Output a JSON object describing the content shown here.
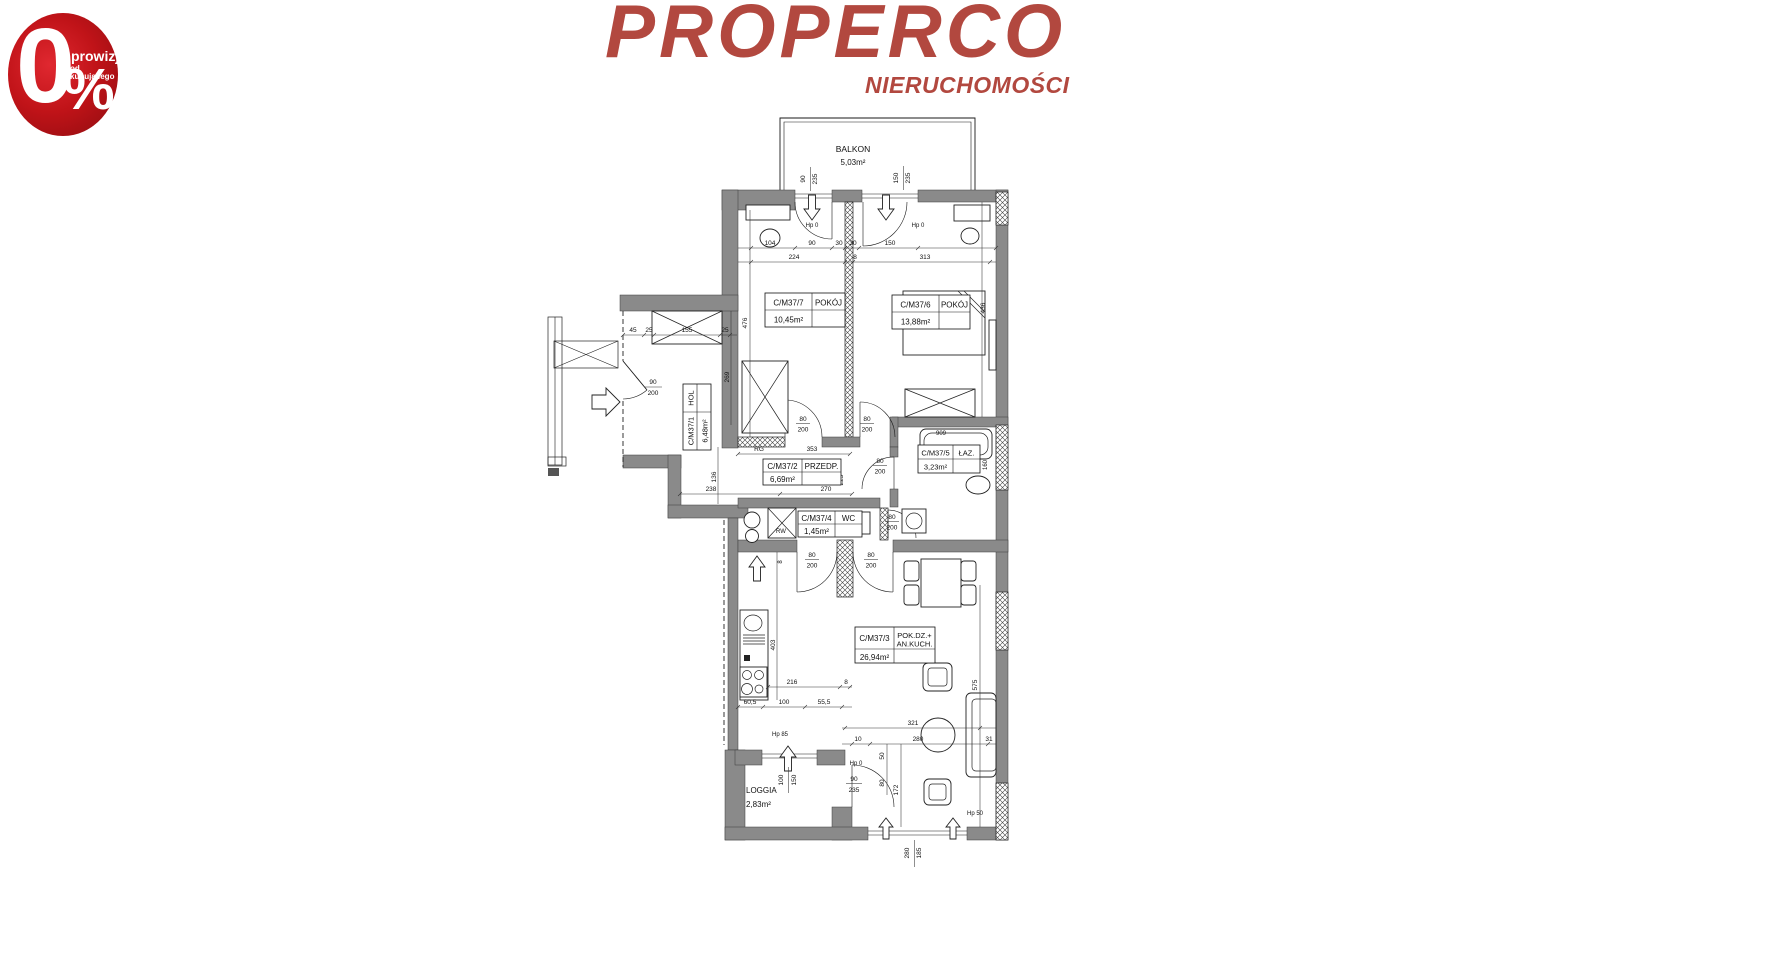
{
  "badge": {
    "zero": "0",
    "percent": "%",
    "line1": "prowizji",
    "line2": "od kupującego"
  },
  "logo": {
    "title": "PROPERCO",
    "subtitle": "NIERUCHOMOŚCI"
  },
  "colors": {
    "brand_red": "#b2483f",
    "badge_red": "#c01318",
    "badge_red_dark": "#8c0c10",
    "wall_gray": "#8a8a8a",
    "line_dark": "#1a1a1a"
  },
  "floorplan": {
    "rooms": {
      "r1": {
        "id": "C/M37/1",
        "name": "HOL",
        "area": "6,48m²"
      },
      "r2": {
        "id": "C/M37/2",
        "name": "PRZEDP.",
        "area": "6,69m²"
      },
      "r3": {
        "id": "C/M37/3",
        "name1": "POK.DZ.+",
        "name2": "AN.KUCH.",
        "area": "26,94m²"
      },
      "r4": {
        "id": "C/M37/4",
        "name": "WC",
        "area": "1,45m²"
      },
      "r5": {
        "id": "C/M37/5",
        "name": "ŁAZ.",
        "area": "3,23m²"
      },
      "r6": {
        "id": "C/M37/6",
        "name": "POKÓJ",
        "area": "13,88m²"
      },
      "r7": {
        "id": "C/M37/7",
        "name": "POKÓJ",
        "area": "10,45m²"
      }
    },
    "outdoor": {
      "balkon": {
        "name": "BALKON",
        "area": "5,03m²"
      },
      "loggia": {
        "name": "LOGGIA",
        "area": "2,83m²"
      }
    },
    "openings": {
      "entrance": {
        "w": "90",
        "h": "200"
      },
      "balcony_door1": {
        "w": "90",
        "h": "235"
      },
      "balcony_door2": {
        "w": "150",
        "h": "235"
      },
      "door_room7": {
        "w": "80",
        "h": "200"
      },
      "door_room6": {
        "w": "80",
        "h": "200"
      },
      "door_bath": {
        "w": "80",
        "h": "200"
      },
      "door_wc": {
        "w": "80",
        "h": "200"
      },
      "door_living1": {
        "w": "80",
        "h": "200"
      },
      "door_living2": {
        "w": "80",
        "h": "200"
      },
      "loggia_door": {
        "w": "90",
        "h": "235"
      },
      "loggia_window": {
        "w": "100",
        "h": "150"
      },
      "bottom_window": {
        "w": "280",
        "h": "185"
      }
    },
    "sill_labels": {
      "hp0": "Hp 0",
      "hp85": "Hp 85",
      "hp50": "Hp 50"
    },
    "dims": {
      "top1": [
        "104",
        "90",
        "30",
        "30",
        "150"
      ],
      "top2": [
        "224",
        "8",
        "313"
      ],
      "room7_height": "476",
      "room6_height": "436",
      "hol_height": "269",
      "hol_top": [
        "45",
        "25",
        "155",
        "25"
      ],
      "rg": "RG",
      "hall": "353",
      "lower1": "238",
      "lower2": "270",
      "v136": "136",
      "v225": "225",
      "shaft": "RW",
      "bath": "909",
      "bath_side": "160",
      "kitchen_len": "403",
      "k8": "8",
      "kitchen1": [
        "216",
        "8"
      ],
      "kitchen2": [
        "60,5",
        "100",
        "55,5"
      ],
      "living1": "321",
      "living2": [
        "10",
        "280",
        "31"
      ],
      "v50": "50",
      "v80": "80",
      "v172": "172",
      "v575": "575"
    }
  }
}
